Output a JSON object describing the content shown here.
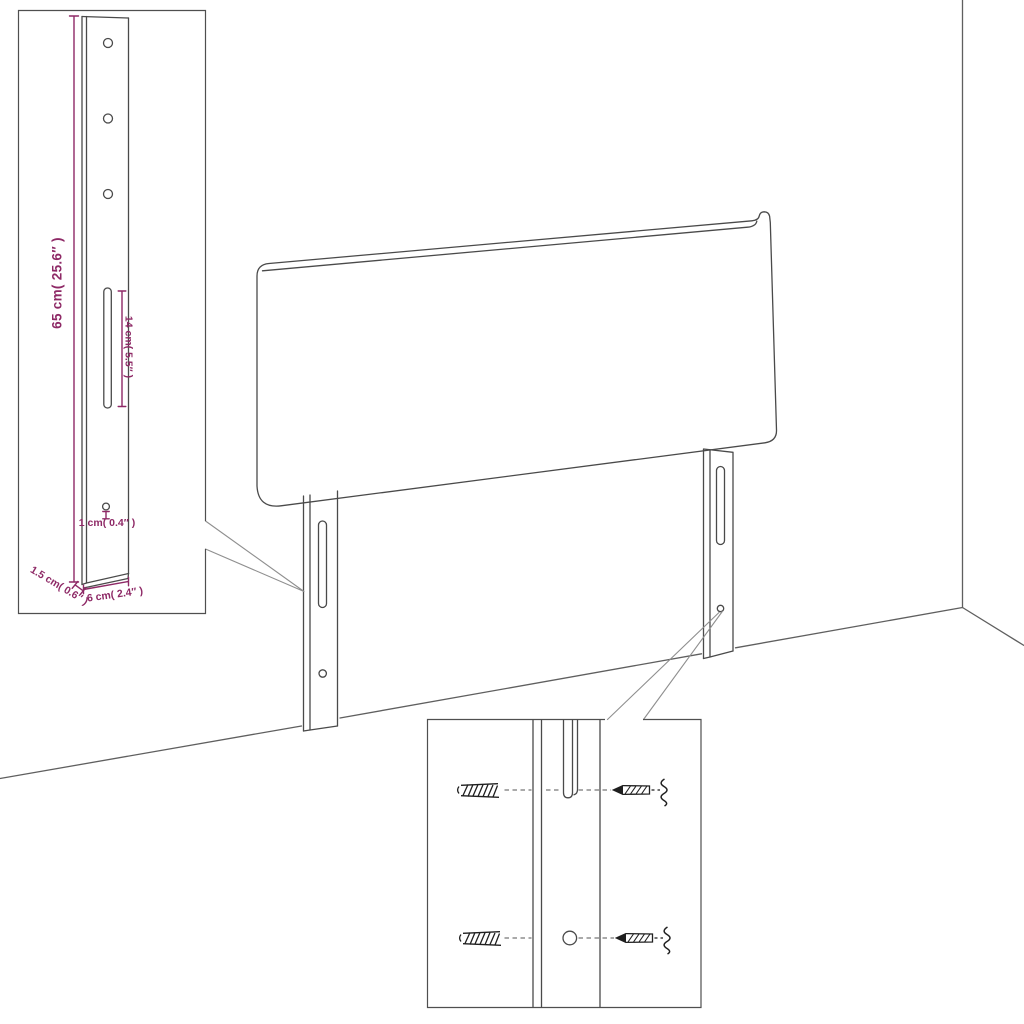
{
  "colors": {
    "background": "#ffffff",
    "line": "#4a4a4a",
    "floor": "#5f5f5f",
    "callout": "#8f8f8f",
    "box_border": "#4f4f4f",
    "hardware_ink": "#1f1f1f",
    "dimension": "#8E2966"
  },
  "illustration": {
    "type": "product-dimension-diagram",
    "subject": "headboard-with-mounting-legs",
    "dimension_labels": {
      "leg_height": "65 cm( 25.6″ )",
      "slot_length": "14 cm( 5.5″ )",
      "hole_diameter": "1 cm( 0.4″ )",
      "leg_thickness": "1.5 cm( 0.6″ )",
      "leg_width": "6 cm( 2.4″ )"
    }
  }
}
